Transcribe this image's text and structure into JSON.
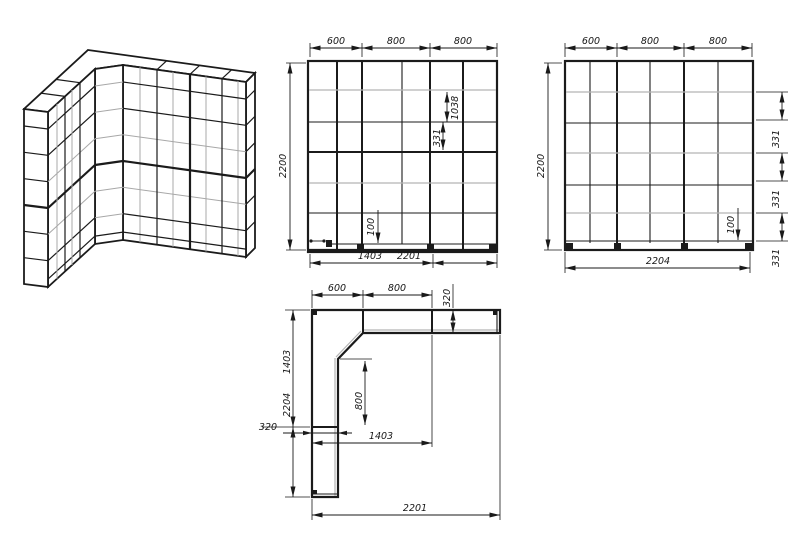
{
  "drawing": {
    "front_view": {
      "top_dims": [
        "600",
        "800",
        "800"
      ],
      "height": "2200",
      "opening_height": "1038",
      "shelf_gap": "331",
      "plinth": "100",
      "bottom_dims": [
        "1403",
        "2201"
      ]
    },
    "side_view": {
      "top_dims": [
        "600",
        "800",
        "800"
      ],
      "height": "2200",
      "shelf_gaps": [
        "331",
        "331",
        "331"
      ],
      "plinth": "100",
      "width": "2204"
    },
    "plan_view": {
      "top_dims": [
        "600",
        "800"
      ],
      "arm_depth": "320",
      "left_dims": [
        "1403",
        "2204"
      ],
      "arm_width": "320",
      "inner_depth": "800",
      "inner_length": "1403",
      "width": "2201"
    },
    "colors": {
      "line": "#1b1b1b",
      "shelf_gray": "#b4b4b4",
      "background": "#ffffff"
    }
  }
}
